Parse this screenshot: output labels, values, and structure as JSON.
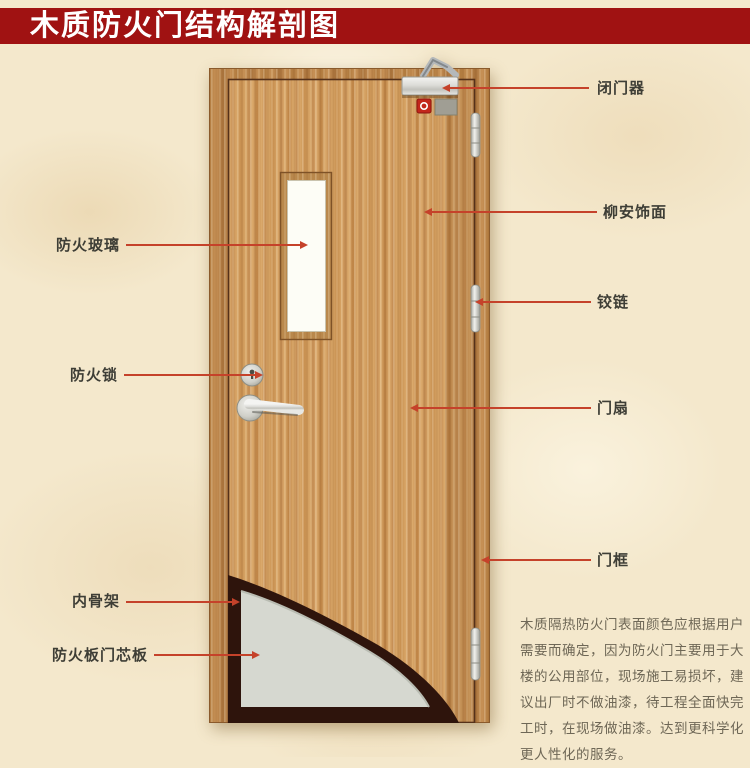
{
  "banner": {
    "title": "木质防火门结构解剖图",
    "bg_color": "#a01212",
    "text_color": "#ffffff"
  },
  "callouts": {
    "left": [
      "防火玻璃",
      "防火锁",
      "内骨架",
      "防火板门芯板"
    ],
    "right": [
      "闭门器",
      "柳安饰面",
      "铰链",
      "门扇",
      "门框"
    ]
  },
  "note": {
    "lines": [
      "木质隔热防火门表面颜色应根据用户",
      "需要而确定，因为防火门主要用于大",
      "楼的公用部位，现场施工易损坏，建",
      "议出厂时不做油漆，待工程全面快完",
      "工时，在现场做油漆。达到更科学化",
      "更人性化的服务。"
    ]
  },
  "colors": {
    "leader_line": "#c5422a",
    "wood_base": "#c9925a",
    "frame_wood": "#b27e44",
    "glass": "#fdfdf6",
    "core_gray": "#d6d8d0",
    "skeleton_dark": "#2e140c",
    "background": "#f4e8cc"
  }
}
